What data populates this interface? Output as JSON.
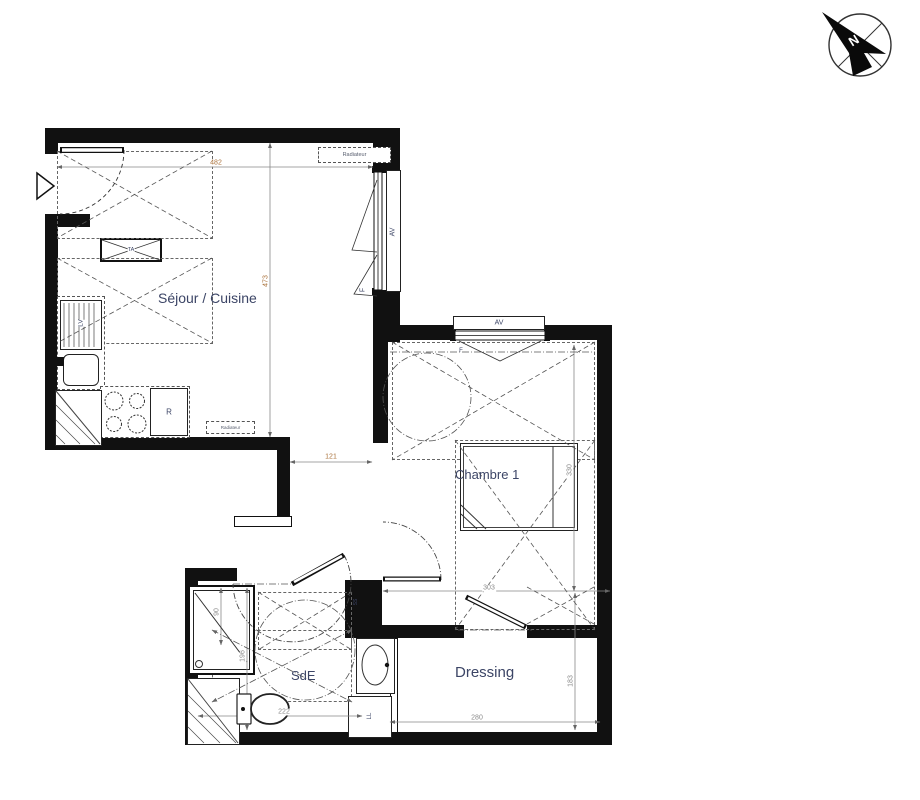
{
  "compass": {
    "north_label": "N"
  },
  "rooms": {
    "sejour": "Séjour / Cuisine",
    "chambre": "Chambre 1",
    "sde": "SdE",
    "dressing": "Dressing"
  },
  "fixtures": {
    "radiateur": "Radiateur",
    "window_sill": "AV",
    "window": "F",
    "sink_unit": "LV",
    "fridge": "R",
    "technical_panel": "TA",
    "washing_machine": "LL",
    "switch": "SS"
  },
  "dimensions": {
    "sejour_width": "482",
    "sejour_height": "473",
    "passage_width": "121",
    "chambre_width": "303",
    "chambre_height": "330",
    "dressing_width": "280",
    "dressing_height": "183",
    "sde_width": "222",
    "sde_height": "196",
    "shower_width": "90"
  },
  "colors": {
    "wall": "#111111",
    "label": "#3c4566",
    "dim": "#8a8a8a",
    "dim_accent": "#a9713a"
  }
}
